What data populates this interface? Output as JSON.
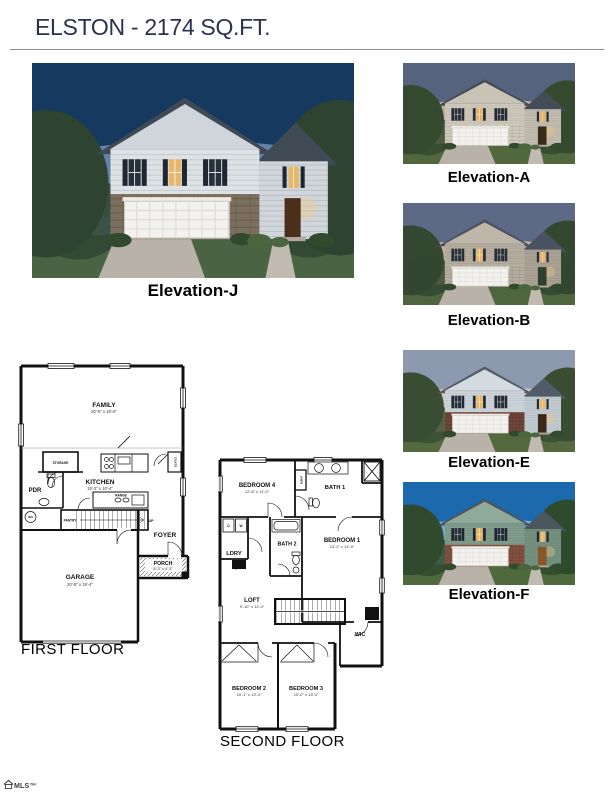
{
  "header": {
    "title": "ELSTON - 2174 SQ.FT."
  },
  "elevations": {
    "main": {
      "label": "Elevation-J"
    },
    "thumbs": [
      {
        "label": "Elevation-A"
      },
      {
        "label": "Elevation-B"
      },
      {
        "label": "Elevation-E"
      },
      {
        "label": "Elevation-F"
      }
    ]
  },
  "first_floor": {
    "caption": "FIRST FLOOR",
    "rooms": {
      "family": {
        "name": "FAMILY",
        "dim": "20'-5\" x 15'-0\""
      },
      "kitchen": {
        "name": "KITCHEN",
        "dim": "15'-2\" x 10'-4\""
      },
      "storage": {
        "name": "STORAGE"
      },
      "pdr": {
        "name": "PDR"
      },
      "range": {
        "name": "RANGE"
      },
      "pantry": {
        "name": "PANTRY"
      },
      "foyer": {
        "name": "FOYER"
      },
      "porch": {
        "name": "PORCH",
        "dim": "8'-3\" x 4'-3\""
      },
      "garage": {
        "name": "GARAGE",
        "dim": "20'-5\" x 19'-4\""
      },
      "coats": {
        "name": "COATS"
      },
      "wh": {
        "name": "WH"
      },
      "up": {
        "name": "UP"
      }
    }
  },
  "second_floor": {
    "caption": "SECOND FLOOR",
    "rooms": {
      "bedroom4": {
        "name": "BEDROOM 4",
        "dim": "12'-8\" x 11'-0\""
      },
      "bath1": {
        "name": "BATH 1"
      },
      "linen": {
        "name": "LINEN"
      },
      "bath2": {
        "name": "BATH 2"
      },
      "bedroom1": {
        "name": "BEDROOM 1",
        "dim": "13'-2\" x 14'-9\""
      },
      "ldry": {
        "name": "LDRY"
      },
      "dryer": {
        "name": "D"
      },
      "washer": {
        "name": "W"
      },
      "loft": {
        "name": "LOFT",
        "dim": "9'-10\" x 12'-0\""
      },
      "wic": {
        "name": "WIC"
      },
      "bedroom2": {
        "name": "BEDROOM 2",
        "dim": "10'-1\" x 13'-4\""
      },
      "bedroom3": {
        "name": "BEDROOM 3",
        "dim": "10'-0\" x 13'-4\""
      }
    }
  },
  "footer": {
    "logo_text": "MLS™"
  },
  "colors": {
    "title": "#2b324f",
    "plan_line": "#111111"
  }
}
